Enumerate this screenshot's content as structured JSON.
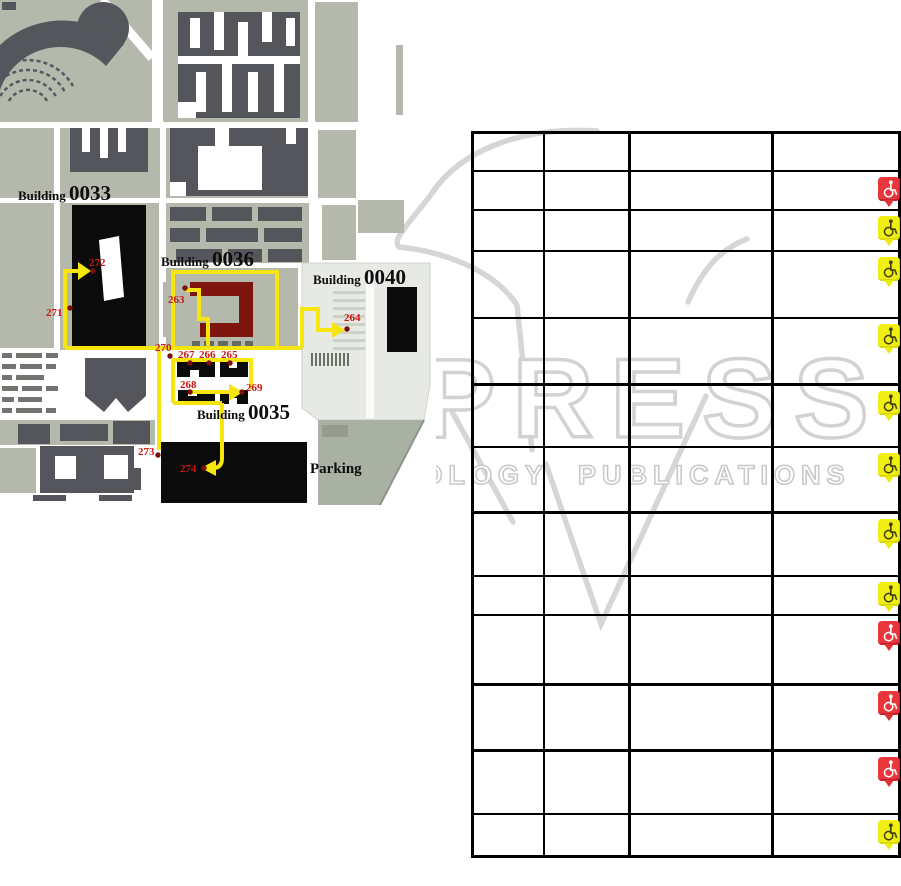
{
  "figure": {
    "description": "Campus map with accessible route waypoints 263-274 and accessibility assessment table"
  },
  "map": {
    "building_labels": [
      {
        "prefix": "Building ",
        "number": "0033",
        "x": 18,
        "y": 200
      },
      {
        "prefix": "Building ",
        "number": "0036",
        "x": 161,
        "y": 266
      },
      {
        "prefix": "Building ",
        "number": "0040",
        "x": 313,
        "y": 284
      },
      {
        "prefix": "Building ",
        "number": "0035",
        "x": 197,
        "y": 419
      }
    ],
    "parking_label": {
      "text": "Parking",
      "x": 310,
      "y": 473
    },
    "waypoints": [
      {
        "n": "263",
        "dot": [
          185,
          288
        ],
        "label": [
          168,
          303
        ]
      },
      {
        "n": "264",
        "dot": [
          347,
          329
        ],
        "label": [
          344,
          321
        ]
      },
      {
        "n": "265",
        "dot": [
          230,
          363
        ],
        "label": [
          221,
          358
        ]
      },
      {
        "n": "266",
        "dot": [
          209,
          363
        ],
        "label": [
          199,
          358
        ]
      },
      {
        "n": "267",
        "dot": [
          190,
          363
        ],
        "label": [
          178,
          358
        ]
      },
      {
        "n": "268",
        "dot": [
          190,
          392
        ],
        "label": [
          180,
          388
        ]
      },
      {
        "n": "269",
        "dot": [
          242,
          392
        ],
        "label": [
          246,
          391
        ]
      },
      {
        "n": "270",
        "dot": [
          170,
          356
        ],
        "label": [
          155,
          351
        ]
      },
      {
        "n": "271",
        "dot": [
          70,
          308
        ],
        "label": [
          46,
          316
        ]
      },
      {
        "n": "272",
        "dot": [
          93,
          271
        ],
        "label": [
          89,
          266
        ]
      },
      {
        "n": "273",
        "dot": [
          158,
          455
        ],
        "label": [
          138,
          455
        ]
      },
      {
        "n": "274",
        "dot": [
          204,
          468
        ],
        "label": [
          180,
          472
        ]
      }
    ],
    "route_color": "#f6e60e",
    "waypoint_dot_color": "#7c0f0c",
    "waypoint_text_color": "#ce1510",
    "building_0036_color": "#7e150e"
  },
  "table": {
    "column_count": 4,
    "header_cells": [
      "",
      "",
      "",
      ""
    ],
    "rows": [
      {
        "icon": "wheelchair-marker",
        "status": "red"
      },
      {
        "icon": "wheelchair-marker",
        "status": "yellow"
      },
      {
        "icon": "wheelchair-marker",
        "status": "yellow"
      },
      {
        "icon": "wheelchair-marker",
        "status": "yellow"
      },
      {
        "icon": "wheelchair-marker",
        "status": "yellow"
      },
      {
        "icon": "wheelchair-marker",
        "status": "yellow"
      },
      {
        "icon": "wheelchair-marker",
        "status": "yellow"
      },
      {
        "icon": "wheelchair-marker",
        "status": "yellow"
      },
      {
        "icon": "wheelchair-marker",
        "status": "red"
      },
      {
        "icon": "wheelchair-marker",
        "status": "red"
      },
      {
        "icon": "wheelchair-marker",
        "status": "red"
      },
      {
        "icon": "wheelchair-marker",
        "status": "yellow"
      }
    ],
    "marker_red": "#e8363c",
    "marker_yellow": "#f0ee12"
  },
  "watermark": {
    "brand": "SCITEPRESS",
    "tagline": "SCIENCE AND TECHNOLOGY PUBLICATIONS",
    "color": "#d2d2d2"
  }
}
